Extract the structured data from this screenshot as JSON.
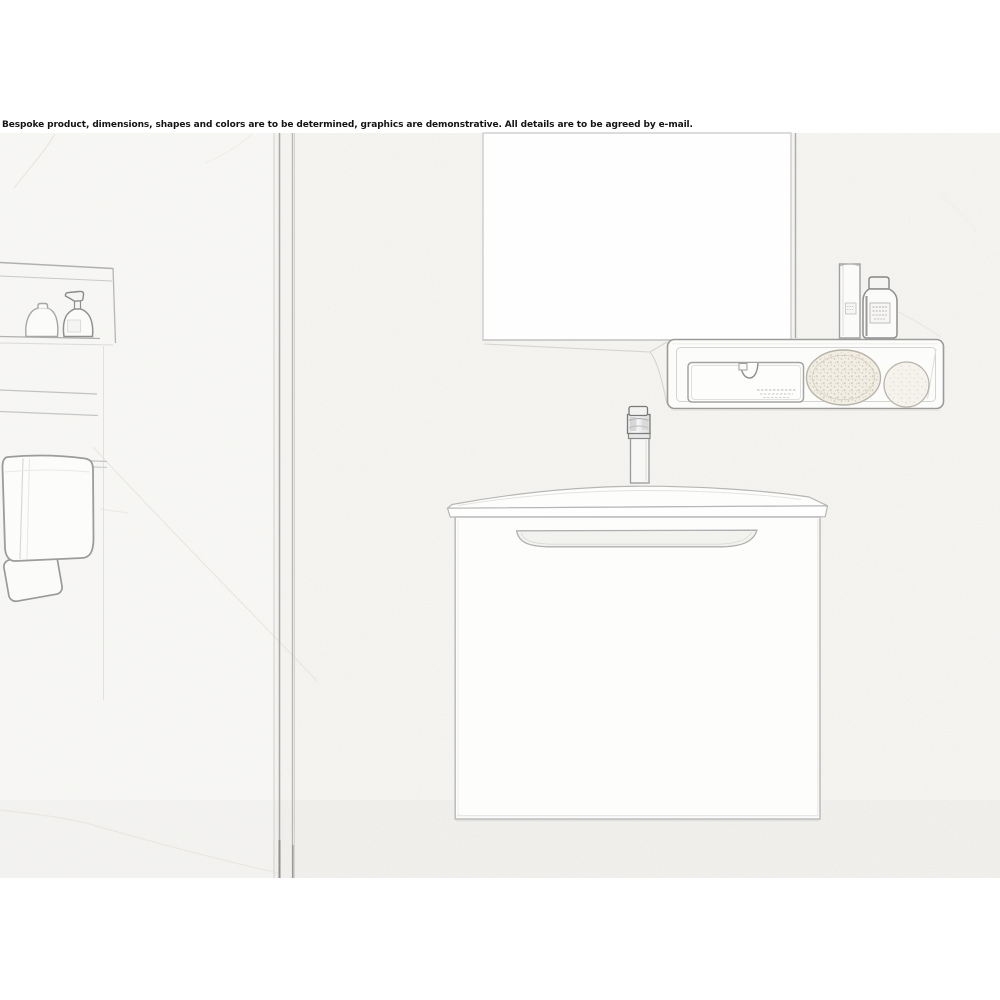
{
  "disclaimer": {
    "text": "Bespoke product, dimensions, shapes and colors are to be determined, graphics are demonstrative. All details are to be agreed by e-mail."
  },
  "colors": {
    "page_background": "#ffffff",
    "wall_texture": "#f6f5f2",
    "sketch_line": "#a9a9a9",
    "sketch_line_dark": "#7d7d7d",
    "sketch_line_faint": "#d8d8d6",
    "mirror_fill": "#fefefe",
    "sponge_fill": "#f2eee4",
    "disclaimer_text": "#141414"
  }
}
